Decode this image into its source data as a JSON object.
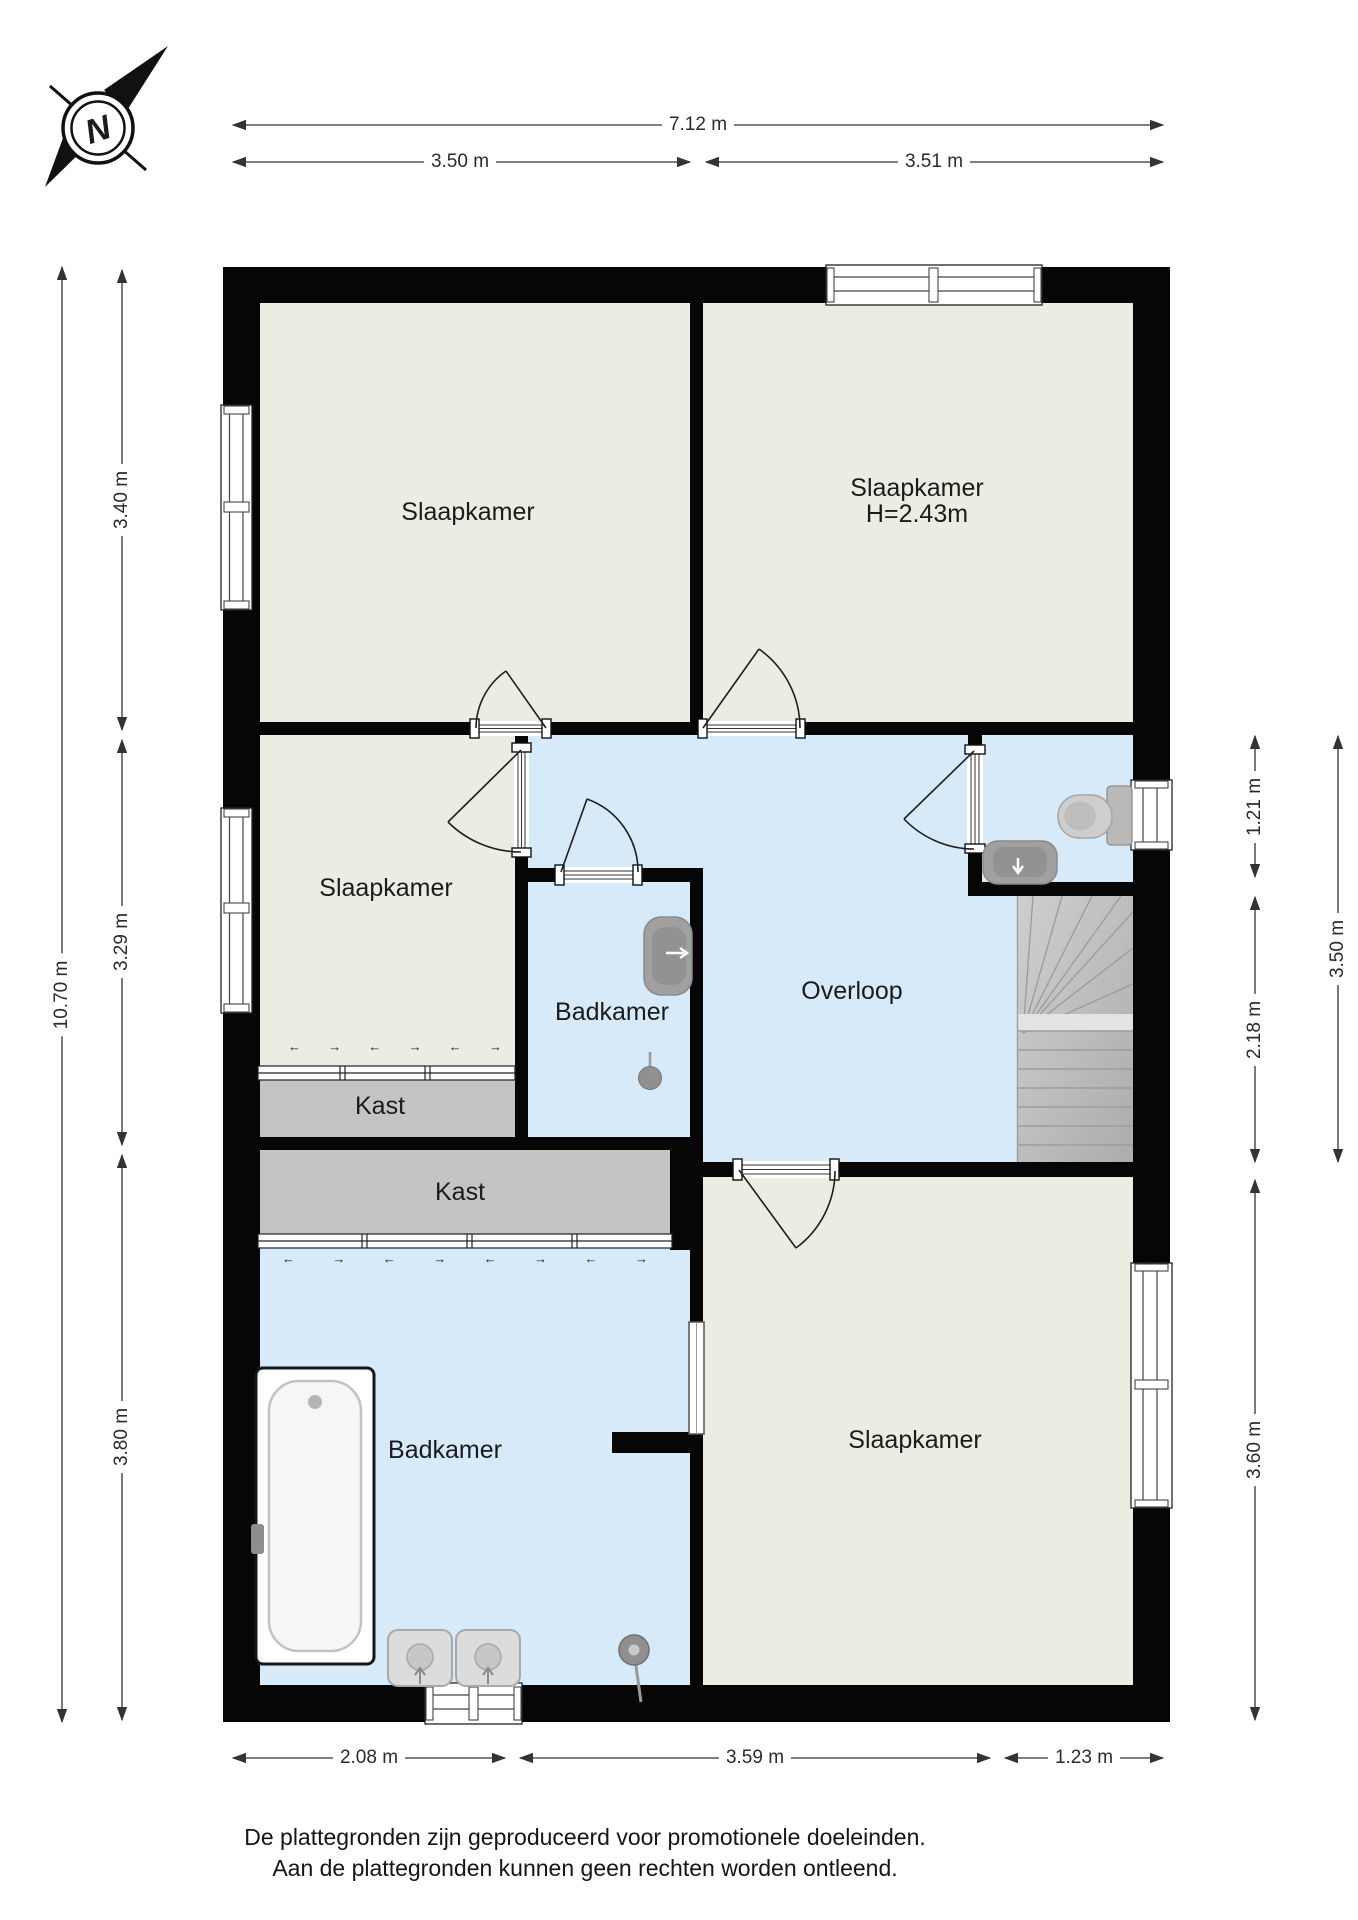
{
  "compass": {
    "label": "N"
  },
  "rooms": {
    "bedroom_top_left": {
      "label": "Slaapkamer"
    },
    "bedroom_top_right": {
      "label": "Slaapkamer",
      "height_note": "H=2.43m"
    },
    "bedroom_middle_left": {
      "label": "Slaapkamer"
    },
    "bathroom_middle": {
      "label": "Badkamer"
    },
    "landing": {
      "label": "Overloop"
    },
    "closet_top": {
      "label": "Kast"
    },
    "closet_bottom": {
      "label": "Kast"
    },
    "bathroom_bottom": {
      "label": "Badkamer"
    },
    "bedroom_bottom_right": {
      "label": "Slaapkamer"
    }
  },
  "dimensions": {
    "top": [
      {
        "value": "7.12 m"
      },
      {
        "value": "3.50 m"
      },
      {
        "value": "3.51 m"
      }
    ],
    "bottom": [
      {
        "value": "2.08 m"
      },
      {
        "value": "3.59 m"
      },
      {
        "value": "1.23 m"
      }
    ],
    "left": [
      {
        "value": "10.70 m"
      },
      {
        "value": "3.40 m"
      },
      {
        "value": "3.29 m"
      },
      {
        "value": "3.80 m"
      }
    ],
    "right": [
      {
        "value": "1.21 m"
      },
      {
        "value": "2.18 m"
      },
      {
        "value": "3.60 m"
      },
      {
        "value": "3.50 m"
      }
    ]
  },
  "wardrobe_marks": {
    "left": "←",
    "right": "→"
  },
  "footer": {
    "line1": "De plattegronden zijn geproduceerd voor promotionele doeleinden.",
    "line2": "Aan de plattegronden kunnen geen rechten worden ontleend."
  },
  "colors": {
    "room_fill": "#EDECE3",
    "wet_room_fill": "#D6EAFA",
    "closet_fill": "#C4C4C4",
    "wall": "#060606",
    "stairs_fill": "#BEBEBE",
    "fixture_gray": "#9E9E9E"
  }
}
